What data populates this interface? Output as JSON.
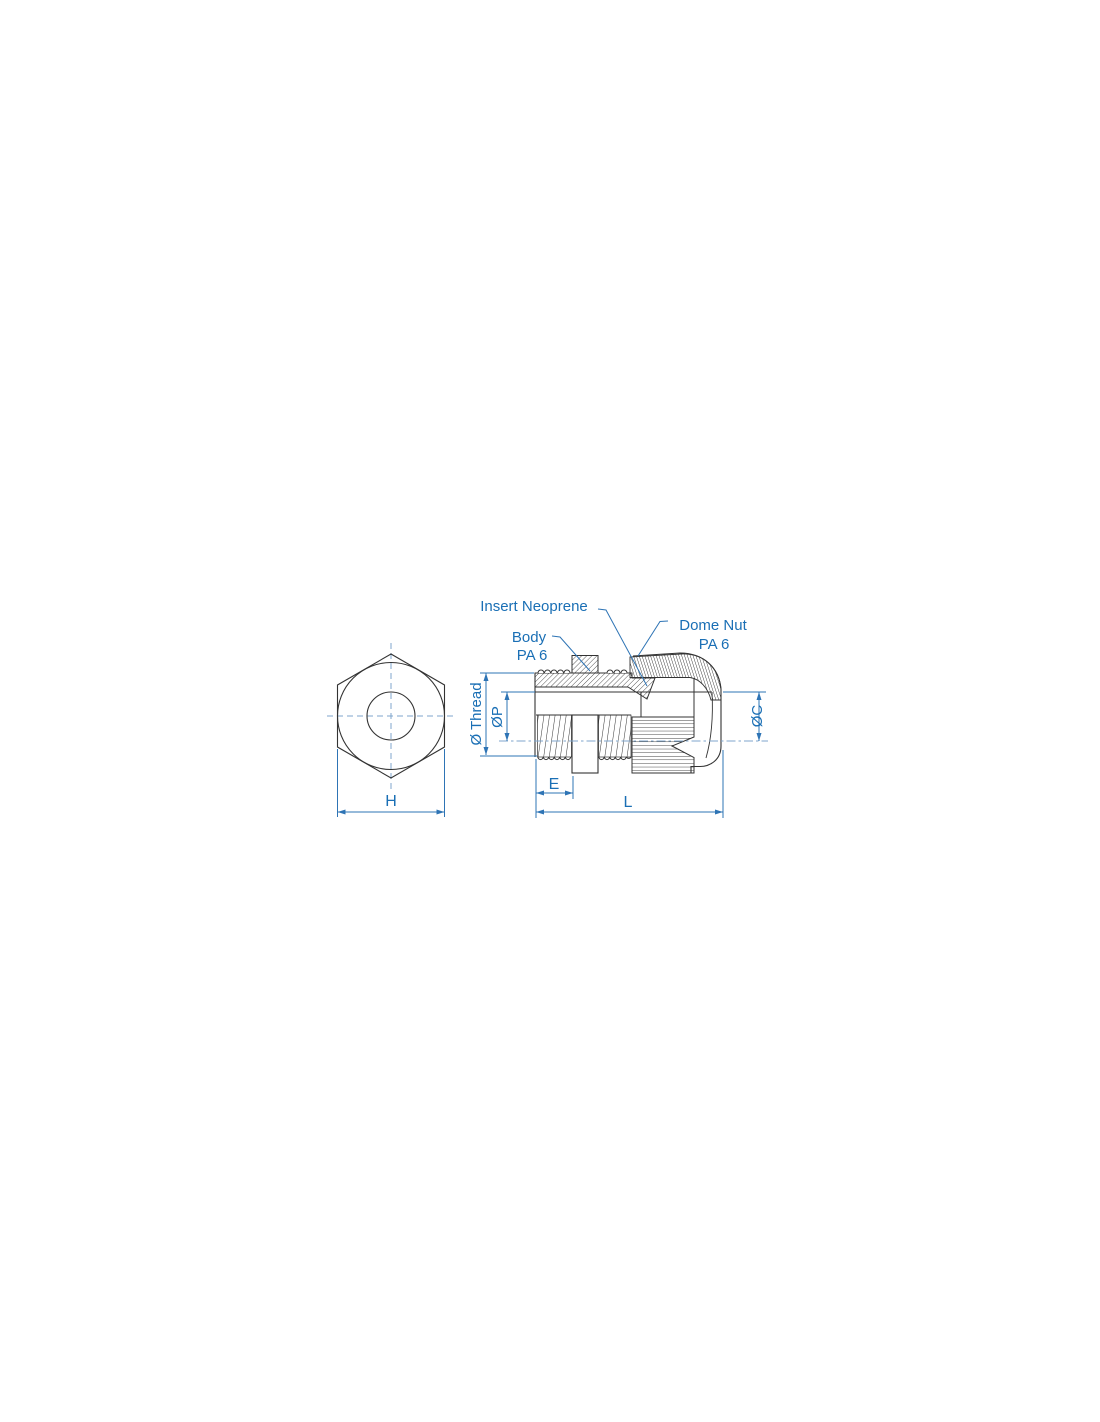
{
  "diagram": {
    "type": "technical-dimension-drawing",
    "subject": "cable gland with dome nut - front and side section views",
    "labels": {
      "insert_neoprene": "Insert Neoprene",
      "body": "Body",
      "body_material": "PA 6",
      "dome_nut": "Dome Nut",
      "dome_nut_material": "PA 6",
      "dim_thread_diameter": "Ø Thread",
      "dim_p_diameter": "ØP",
      "dim_c_diameter": "ØC",
      "dim_hex_width": "H",
      "dim_thread_length": "E",
      "dim_total_length": "L"
    },
    "colors": {
      "drawing_line": "#333333",
      "dimension_blue": "#2e74b5",
      "label_blue": "#1a6fb5",
      "centerline_blue": "#7fa6cc",
      "background": "#ffffff"
    }
  }
}
